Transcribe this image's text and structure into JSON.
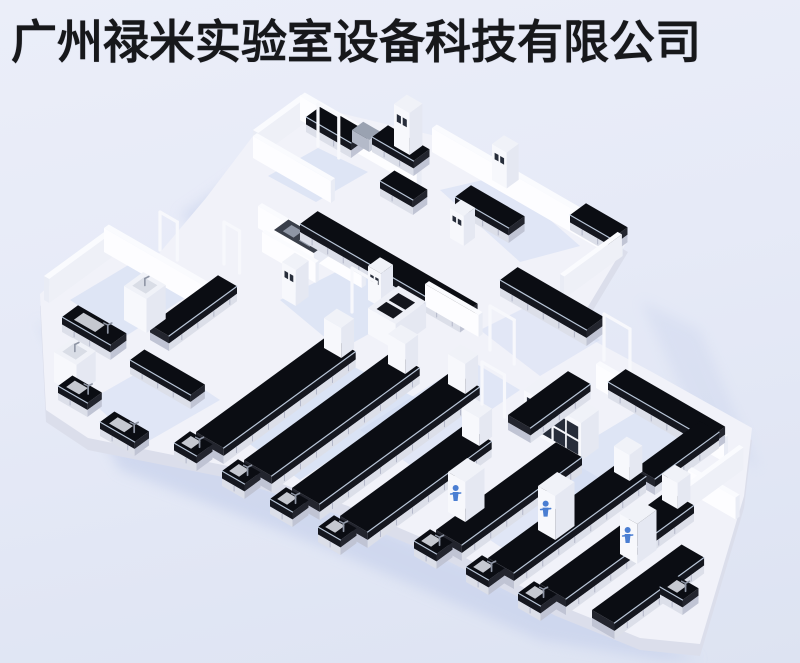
{
  "title": {
    "text": "广州禄米实验室设备科技有限公司"
  },
  "scene": {
    "width": 800,
    "height": 663,
    "iso": {
      "ux": 0.8,
      "uy": -0.585,
      "vx": 0.865,
      "vy": 0.5
    },
    "palette": {
      "benchTop": "#0b0d13",
      "benchBandF": "#15171f",
      "benchBandE": "#23252e",
      "benchLowF": "#dcdfe9",
      "benchLowE": "#c0c4d4",
      "seam": "#b3b7c9",
      "highlight": "#d3e2f6",
      "wallTop": "#fafbfe",
      "wallBright": "#fdfdff",
      "wallShade": "#e9ecf5",
      "towerTop": "#f0f2f8",
      "towerBright": "#f7f8fc",
      "towerShade": "#e5e8f2",
      "pane": "#272d3a",
      "floorTop": "#f1f2f9",
      "skirt": "#dbdeeb",
      "shadow": "#c8d2ec",
      "tint": "#ccd8f2",
      "basin": "#d9dde6",
      "faucet": "#8e95a4",
      "figure": "#4a7ed2",
      "grayTop": "#9aa2b1",
      "grayItem": "#8f96a5",
      "applTop": "#3a3f4a",
      "frame": "#f7f8fc",
      "trayDark": "#14161d",
      "stationTop": "#eef0f7"
    },
    "footprint": [
      [
        253,
        148
      ],
      [
        302,
        116
      ],
      [
        436,
        148
      ],
      [
        552,
        208
      ],
      [
        628,
        252
      ],
      [
        574,
        342
      ],
      [
        652,
        384
      ],
      [
        752,
        440
      ],
      [
        744,
        508
      ],
      [
        700,
        656
      ],
      [
        640,
        650
      ],
      [
        556,
        616
      ],
      [
        446,
        560
      ],
      [
        348,
        518
      ],
      [
        228,
        478
      ],
      [
        88,
        450
      ],
      [
        46,
        422
      ],
      [
        40,
        306
      ],
      [
        104,
        248
      ],
      [
        152,
        274
      ],
      [
        206,
        210
      ]
    ],
    "shadows": [
      {
        "pts": [
          [
            36,
            320
          ],
          [
            120,
            470
          ],
          [
            330,
            550
          ],
          [
            540,
            640
          ],
          [
            660,
            660
          ],
          [
            700,
            660
          ],
          [
            480,
            570
          ],
          [
            240,
            468
          ],
          [
            70,
            350
          ]
        ],
        "op": 0.7
      },
      {
        "pts": [
          [
            180,
            215
          ],
          [
            256,
            162
          ],
          [
            300,
            190
          ],
          [
            222,
            252
          ]
        ],
        "op": 0.55
      },
      {
        "pts": [
          [
            640,
            300
          ],
          [
            700,
            430
          ],
          [
            760,
            470
          ],
          [
            700,
            330
          ]
        ],
        "op": 0.35
      }
    ],
    "tints": [
      {
        "pts": [
          [
            70,
            300
          ],
          [
            140,
            258
          ],
          [
            200,
            288
          ],
          [
            126,
            336
          ]
        ],
        "op": 0.5
      },
      {
        "pts": [
          [
            268,
            176
          ],
          [
            318,
            148
          ],
          [
            368,
            172
          ],
          [
            316,
            202
          ]
        ],
        "op": 0.5
      },
      {
        "pts": [
          [
            440,
            190
          ],
          [
            500,
            176
          ],
          [
            580,
            246
          ],
          [
            520,
            262
          ]
        ],
        "op": 0.45
      },
      {
        "pts": [
          [
            280,
            300
          ],
          [
            360,
            260
          ],
          [
            430,
            300
          ],
          [
            340,
            350
          ]
        ],
        "op": 0.5
      },
      {
        "pts": [
          [
            230,
            430
          ],
          [
            340,
            360
          ],
          [
            420,
            400
          ],
          [
            300,
            480
          ]
        ],
        "op": 0.6
      },
      {
        "pts": [
          [
            540,
            470
          ],
          [
            640,
            410
          ],
          [
            700,
            450
          ],
          [
            600,
            520
          ]
        ],
        "op": 0.5
      },
      {
        "pts": [
          [
            90,
            400
          ],
          [
            160,
            360
          ],
          [
            220,
            400
          ],
          [
            140,
            446
          ]
        ],
        "op": 0.45
      },
      {
        "pts": [
          [
            480,
            330
          ],
          [
            540,
            300
          ],
          [
            600,
            340
          ],
          [
            540,
            376
          ]
        ],
        "op": 0.4
      },
      {
        "pts": [
          [
            360,
            430
          ],
          [
            470,
            360
          ],
          [
            520,
            390
          ],
          [
            410,
            465
          ]
        ],
        "op": 0.45
      },
      {
        "pts": [
          [
            460,
            520
          ],
          [
            560,
            455
          ],
          [
            620,
            490
          ],
          [
            520,
            560
          ]
        ],
        "op": 0.45
      }
    ],
    "items": [
      {
        "t": "wall",
        "p": [
          253,
          154
        ],
        "du": 60,
        "dv": 6,
        "h": 24
      },
      {
        "t": "wall",
        "p": [
          300,
          120
        ],
        "du": 6,
        "dv": 135,
        "h": 24
      },
      {
        "t": "bench",
        "p": [
          306,
          132
        ],
        "du": 20,
        "dv": 52,
        "h": 15
      },
      {
        "t": "appliance",
        "p": [
          352,
          142
        ],
        "du": 14,
        "dv": 20,
        "h": 12
      },
      {
        "t": "frame",
        "p": [
          318,
          146
        ],
        "w": 24,
        "h": 42
      },
      {
        "t": "bench",
        "p": [
          372,
          152
        ],
        "du": 20,
        "dv": 48,
        "h": 15
      },
      {
        "t": "tower",
        "p": [
          394,
          146
        ],
        "du": 16,
        "dv": 18,
        "h": 42,
        "panes": true
      },
      {
        "t": "wall",
        "p": [
          253,
          158
        ],
        "du": 5,
        "dv": 90,
        "h": 22
      },
      {
        "t": "wall",
        "p": [
          432,
          152
        ],
        "du": 6,
        "dv": 215,
        "h": 24
      },
      {
        "t": "bench",
        "p": [
          380,
          196
        ],
        "du": 18,
        "dv": 38,
        "h": 15
      },
      {
        "t": "bench",
        "p": [
          455,
          212
        ],
        "du": 20,
        "dv": 62,
        "h": 15
      },
      {
        "t": "tower",
        "p": [
          492,
          180
        ],
        "du": 15,
        "dv": 17,
        "h": 36,
        "panes": true
      },
      {
        "t": "bench",
        "p": [
          570,
          230
        ],
        "du": 20,
        "dv": 48,
        "h": 15
      },
      {
        "t": "tower",
        "p": [
          450,
          238
        ],
        "du": 14,
        "dv": 16,
        "h": 30,
        "panes": true
      },
      {
        "t": "wall",
        "p": [
          560,
          296
        ],
        "du": 72,
        "dv": 5,
        "h": 22
      },
      {
        "t": "wall",
        "p": [
          44,
          300
        ],
        "du": 78,
        "dv": 6,
        "h": 24
      },
      {
        "t": "wall",
        "p": [
          104,
          252
        ],
        "du": 6,
        "dv": 128,
        "h": 24
      },
      {
        "t": "frame",
        "p": [
          160,
          250
        ],
        "w": 20,
        "h": 38
      },
      {
        "t": "frame",
        "p": [
          224,
          264
        ],
        "w": 18,
        "h": 42
      },
      {
        "t": "wall",
        "p": [
          258,
          228
        ],
        "du": 5,
        "dv": 120,
        "h": 22
      },
      {
        "t": "abench",
        "p": [
          274,
          244
        ],
        "du": 18,
        "dv": 46,
        "h": 14
      },
      {
        "t": "wall",
        "p": [
          262,
          252
        ],
        "du": 4,
        "dv": 62,
        "h": 20
      },
      {
        "t": "bench",
        "p": [
          300,
          240
        ],
        "du": 22,
        "dv": 185,
        "h": 16
      },
      {
        "t": "tower",
        "p": [
          282,
          298
        ],
        "du": 16,
        "dv": 16,
        "h": 36,
        "panes": true
      },
      {
        "t": "tower",
        "p": [
          368,
          300
        ],
        "du": 15,
        "dv": 15,
        "h": 34,
        "panes": true
      },
      {
        "t": "wall",
        "p": [
          425,
          306
        ],
        "du": 5,
        "dv": 62,
        "h": 22
      },
      {
        "t": "frame",
        "p": [
          352,
          312
        ],
        "w": 28,
        "h": 44
      },
      {
        "t": "bench",
        "p": [
          500,
          296
        ],
        "du": 22,
        "dv": 100,
        "h": 16
      },
      {
        "t": "bench",
        "p": [
          150,
          340
        ],
        "du": 85,
        "dv": 22,
        "h": 15
      },
      {
        "t": "tower",
        "p": [
          124,
          320
        ],
        "du": 24,
        "dv": 26,
        "h": 34,
        "basin": true
      },
      {
        "t": "sink",
        "p": [
          62,
          332
        ],
        "du": 20,
        "dv": 56,
        "h": 15
      },
      {
        "t": "station",
        "p": [
          368,
          334
        ],
        "du": 38,
        "dv": 32,
        "h": 26
      },
      {
        "t": "frame",
        "p": [
          490,
          350
        ],
        "w": 28,
        "h": 44
      },
      {
        "t": "bench",
        "p": [
          130,
          374
        ],
        "du": 18,
        "dv": 70,
        "h": 14
      },
      {
        "t": "tower",
        "p": [
          54,
          382
        ],
        "du": 24,
        "dv": 26,
        "h": 30,
        "basin": true
      },
      {
        "t": "sink",
        "p": [
          58,
          400
        ],
        "du": 18,
        "dv": 34,
        "h": 14
      },
      {
        "t": "sink",
        "p": [
          100,
          436
        ],
        "du": 18,
        "dv": 40,
        "h": 14
      },
      {
        "t": "tower",
        "p": [
          524,
          428
        ],
        "du": 22,
        "dv": 66,
        "h": 38,
        "grid": true
      },
      {
        "t": "wall",
        "p": [
          596,
          388
        ],
        "du": 5,
        "dv": 148,
        "h": 24
      },
      {
        "t": "frame",
        "p": [
          604,
          360
        ],
        "w": 30,
        "h": 46
      },
      {
        "t": "bench",
        "p": [
          608,
          398
        ],
        "du": 22,
        "dv": 115,
        "h": 16
      },
      {
        "t": "bench",
        "p": [
          636,
          484
        ],
        "du": 80,
        "dv": 22,
        "h": 16
      },
      {
        "t": "wall",
        "p": [
          688,
          492
        ],
        "du": 5,
        "dv": 55,
        "h": 22
      },
      {
        "t": "wall",
        "p": [
          672,
          516
        ],
        "du": 84,
        "dv": 5,
        "h": 22
      },
      {
        "t": "bench",
        "p": [
          196,
          448
        ],
        "du": 165,
        "dv": 32,
        "h": 16
      },
      {
        "t": "tower",
        "p": [
          324,
          348
        ],
        "du": 16,
        "dv": 20,
        "h": 30
      },
      {
        "t": "sink",
        "p": [
          174,
          458
        ],
        "du": 20,
        "dv": 26,
        "h": 15
      },
      {
        "t": "bench",
        "p": [
          244,
          476
        ],
        "du": 185,
        "dv": 32,
        "h": 16
      },
      {
        "t": "tower",
        "p": [
          388,
          364
        ],
        "du": 16,
        "dv": 20,
        "h": 30
      },
      {
        "t": "sink",
        "p": [
          222,
          486
        ],
        "du": 20,
        "dv": 26,
        "h": 15
      },
      {
        "t": "bench",
        "p": [
          292,
          504
        ],
        "du": 200,
        "dv": 32,
        "h": 16
      },
      {
        "t": "tower",
        "p": [
          448,
          384
        ],
        "du": 16,
        "dv": 20,
        "h": 30
      },
      {
        "t": "sink",
        "p": [
          270,
          514
        ],
        "du": 20,
        "dv": 26,
        "h": 15
      },
      {
        "t": "bench",
        "p": [
          340,
          532
        ],
        "du": 155,
        "dv": 32,
        "h": 16
      },
      {
        "t": "tower",
        "p": [
          462,
          436
        ],
        "du": 16,
        "dv": 20,
        "h": 28
      },
      {
        "t": "frame",
        "p": [
          482,
          404
        ],
        "w": 26,
        "h": 42
      },
      {
        "t": "sink",
        "p": [
          318,
          542
        ],
        "du": 20,
        "dv": 26,
        "h": 15
      },
      {
        "t": "bench",
        "p": [
          508,
          430
        ],
        "du": 75,
        "dv": 26,
        "h": 15
      },
      {
        "t": "bench",
        "p": [
          436,
          546
        ],
        "du": 150,
        "dv": 30,
        "h": 16
      },
      {
        "t": "figure",
        "p": [
          448,
          512
        ],
        "du": 24,
        "dv": 20,
        "h": 40
      },
      {
        "t": "sink",
        "p": [
          414,
          556
        ],
        "du": 20,
        "dv": 26,
        "h": 15
      },
      {
        "t": "bench",
        "p": [
          488,
          574
        ],
        "du": 165,
        "dv": 30,
        "h": 16
      },
      {
        "t": "figure",
        "p": [
          538,
          530
        ],
        "du": 24,
        "dv": 20,
        "h": 44
      },
      {
        "t": "tower",
        "p": [
          614,
          472
        ],
        "du": 16,
        "dv": 18,
        "h": 26
      },
      {
        "t": "sink",
        "p": [
          466,
          582
        ],
        "du": 20,
        "dv": 26,
        "h": 15
      },
      {
        "t": "bench",
        "p": [
          540,
          600
        ],
        "du": 160,
        "dv": 30,
        "h": 16
      },
      {
        "t": "tower",
        "p": [
          662,
          500
        ],
        "du": 16,
        "dv": 18,
        "h": 26
      },
      {
        "t": "sink",
        "p": [
          518,
          608
        ],
        "du": 20,
        "dv": 26,
        "h": 15
      },
      {
        "t": "bench",
        "p": [
          592,
          626
        ],
        "du": 112,
        "dv": 26,
        "h": 16
      },
      {
        "t": "figure",
        "p": [
          620,
          554
        ],
        "du": 24,
        "dv": 20,
        "h": 40
      },
      {
        "t": "sink",
        "p": [
          660,
          602
        ],
        "du": 20,
        "dv": 26,
        "h": 15
      }
    ]
  }
}
